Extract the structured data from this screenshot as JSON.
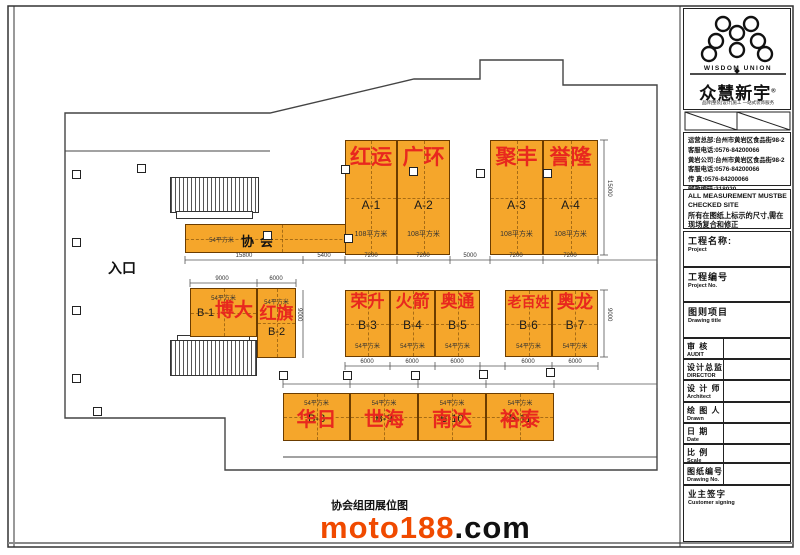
{
  "colors": {
    "booth_fill": "#F5A62B",
    "booth_name_red": "#E8281E",
    "watermark_orange": "#F04A00"
  },
  "logo": {
    "en": "WISDOM UNION",
    "cn": "众慧新宇",
    "reg": "®",
    "tagline": "品牌|整装|设计|施工  一站式装饰服务"
  },
  "contact": {
    "lines": [
      "运营总部:台州市黄岩区食品街98-2",
      "客服电话:0576-84200066",
      "黄岩公司:台州市黄岩区食品街98-2",
      "客服电话:0576-84200066",
      "传  真:0576-84200066",
      "邮政编码:318020"
    ]
  },
  "notice": {
    "en1": "ALL MEASUREMENT MUSTBE",
    "en2": "CHECKED    SITE",
    "cn1": "所有在图纸上标示的尺寸,需在",
    "cn2": "现场复合和修正"
  },
  "fields": [
    {
      "cn": "工程名称:",
      "en": "Project"
    },
    {
      "cn": "工程编号",
      "en": "Project No."
    },
    {
      "cn": "图则项目",
      "en": "Drawing title"
    },
    {
      "cn": "审  核",
      "en": "AUDIT"
    },
    {
      "cn": "设计总监",
      "en": "DIRECTOR"
    },
    {
      "cn": "设 计 师",
      "en": "Architect"
    },
    {
      "cn": "绘 图 人",
      "en": "Drawn"
    },
    {
      "cn": "日  期",
      "en": "Date"
    },
    {
      "cn": "比  例",
      "en": "Scale"
    },
    {
      "cn": "图纸编号",
      "en": "Drawing No."
    },
    {
      "cn": "业主签字",
      "en": "Customer signing"
    }
  ],
  "plan": {
    "entrance_label": "入口",
    "association_booth": {
      "name": "协会",
      "area": "54平方米"
    },
    "booths_a": [
      {
        "id": "A-1",
        "name": "红运",
        "area": "108平方米"
      },
      {
        "id": "A-2",
        "name": "广环",
        "area": "108平方米"
      },
      {
        "id": "A-3",
        "name": "聚丰",
        "area": "108平方米"
      },
      {
        "id": "A-4",
        "name": "誉隆",
        "area": "108平方米"
      }
    ],
    "booths_b_left": [
      {
        "id": "B-1",
        "name": "博大",
        "area": "54平方米"
      },
      {
        "id": "B-2",
        "name": "红旗",
        "area": "54平方米"
      }
    ],
    "booths_b_mid": [
      {
        "id": "B-3",
        "name": "荣升",
        "area": "54平方米"
      },
      {
        "id": "B-4",
        "name": "火箭",
        "area": "54平方米"
      },
      {
        "id": "B-5",
        "name": "奥通",
        "area": "54平方米"
      },
      {
        "id": "B-6",
        "name": "老百姓",
        "area": "54平方米"
      },
      {
        "id": "B-7",
        "name": "奥龙",
        "area": "54平方米"
      }
    ],
    "booths_b_bottom": [
      {
        "id": "B-8",
        "name": "华日",
        "area": "54平方米"
      },
      {
        "id": "B-9",
        "name": "世海",
        "area": "54平方米"
      },
      {
        "id": "B-10",
        "name": "南达",
        "area": "54平方米"
      },
      {
        "id": "B-11",
        "name": "裕泰",
        "area": "54平方米"
      }
    ],
    "dims": {
      "assoc_w": "15800",
      "gap1": "5400",
      "a1": "7200",
      "a2": "7200",
      "a_gap": "5000",
      "a3": "7200",
      "a4": "7200",
      "a_h": "15000",
      "b1_w": "9000",
      "b2_w": "6000",
      "b2_h": "9000",
      "b3": "6000",
      "b4": "6000",
      "b5": "6000",
      "b6": "6000",
      "b7": "6000",
      "b_h": "9000"
    }
  },
  "footer": {
    "caption": "协会组团展位图",
    "watermark_main": "moto188",
    "watermark_suffix": ".com"
  }
}
